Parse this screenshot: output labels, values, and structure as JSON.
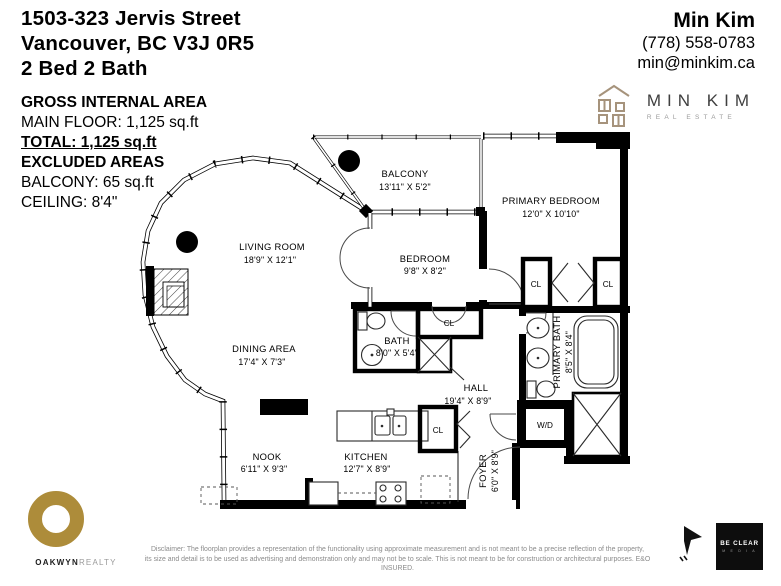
{
  "header": {
    "address_line1": "1503-323 Jervis Street",
    "address_line2": "Vancouver, BC V3J 0R5",
    "address_line3": "2 Bed 2 Bath",
    "agent_name": "Min Kim",
    "agent_phone": "(778) 558-0783",
    "agent_email": "min@minkim.ca",
    "brand_name": "MIN KIM",
    "brand_sub": "REAL ESTATE"
  },
  "area_summary": {
    "gross_title": "GROSS INTERNAL AREA",
    "main_floor": "MAIN FLOOR: 1,125 sq.ft",
    "total": "TOTAL:  1,125 sq.ft",
    "excluded_title": "EXCLUDED AREAS",
    "balcony": "BALCONY: 65 sq.ft",
    "ceiling": "CEILING: 8'4\""
  },
  "rooms": {
    "balcony": {
      "name": "BALCONY",
      "dims": "13'11\" X 5'2\""
    },
    "primary_bedroom": {
      "name": "PRIMARY BEDROOM",
      "dims": "12'0\" X 10'10\""
    },
    "bedroom": {
      "name": "BEDROOM",
      "dims": "9'8\" X 8'2\""
    },
    "living_room": {
      "name": "LIVING ROOM",
      "dims": "18'9\" X 12'1\""
    },
    "dining_area": {
      "name": "DINING AREA",
      "dims": "17'4\" X 7'3\""
    },
    "bath": {
      "name": "BATH",
      "dims": "8'0\" X 5'4\""
    },
    "hall": {
      "name": "HALL",
      "dims": "19'4\" X 8'9\""
    },
    "primary_bath": {
      "name": "PRIMARY BATH",
      "dims": "8'5\" X 8'4\""
    },
    "nook": {
      "name": "NOOK",
      "dims": "6'11\" X 9'3\""
    },
    "kitchen": {
      "name": "KITCHEN",
      "dims": "12'7\" X 8'9\""
    },
    "foyer": {
      "name": "FOYER",
      "dims": "6'0\" X 8'9\""
    },
    "closet_label": "CL",
    "washer_dryer_label": "W/D"
  },
  "footer": {
    "brokerage_bold": "OAKWYN",
    "brokerage_light": "REALTY",
    "disclaimer_line1": "Disclaimer: The floorplan provides a representation of the functionality using approximate measurement and is not meant to be a precise reflection of the property,",
    "disclaimer_line2": "its size and detail is to be used as advertising and demonstration only and may not be to scale. This is not meant to be for construction or architectural purposes. E&O INSURED.",
    "media_name": "BE CLEAR",
    "media_sub": "M E D I A"
  },
  "colors": {
    "gold": "#AD8C3A",
    "tan": "#A6937C",
    "ink": "#000000",
    "gray_text": "#8B8B8B"
  }
}
